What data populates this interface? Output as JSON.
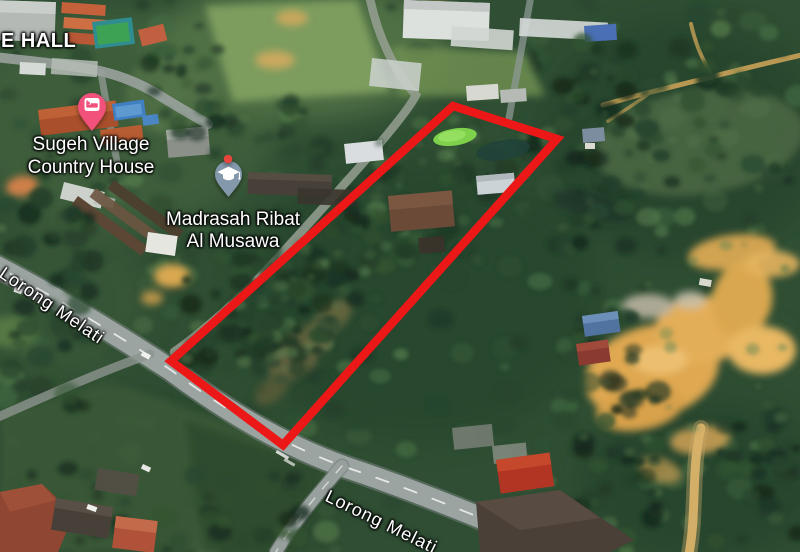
{
  "map": {
    "view": "satellite-imagery",
    "labels": {
      "hall": {
        "text": "E HALL"
      },
      "sugeh": {
        "line1": "Sugeh Village",
        "line2": "Country House"
      },
      "madrasah": {
        "line1": "Madrasah Ribat",
        "line2": "Al Musawa"
      },
      "road_left": {
        "text": "Lorong Melati"
      },
      "road_bottom": {
        "text": "Lorong Melati"
      }
    },
    "pins": {
      "lodging": {
        "name": "lodging-pin",
        "glyph": "bed",
        "color": "#f0527c"
      },
      "education": {
        "name": "education-pin",
        "glyph": "graduation-cap",
        "color": "#8398ab"
      },
      "red_dot": {
        "name": "red-dot-marker",
        "color": "#e8453c"
      }
    },
    "highlight": {
      "shape": "quadrilateral",
      "points": "453,106 557,139 283,445 171,361",
      "color": "#ec1717",
      "stroke_width": 8.5
    }
  }
}
